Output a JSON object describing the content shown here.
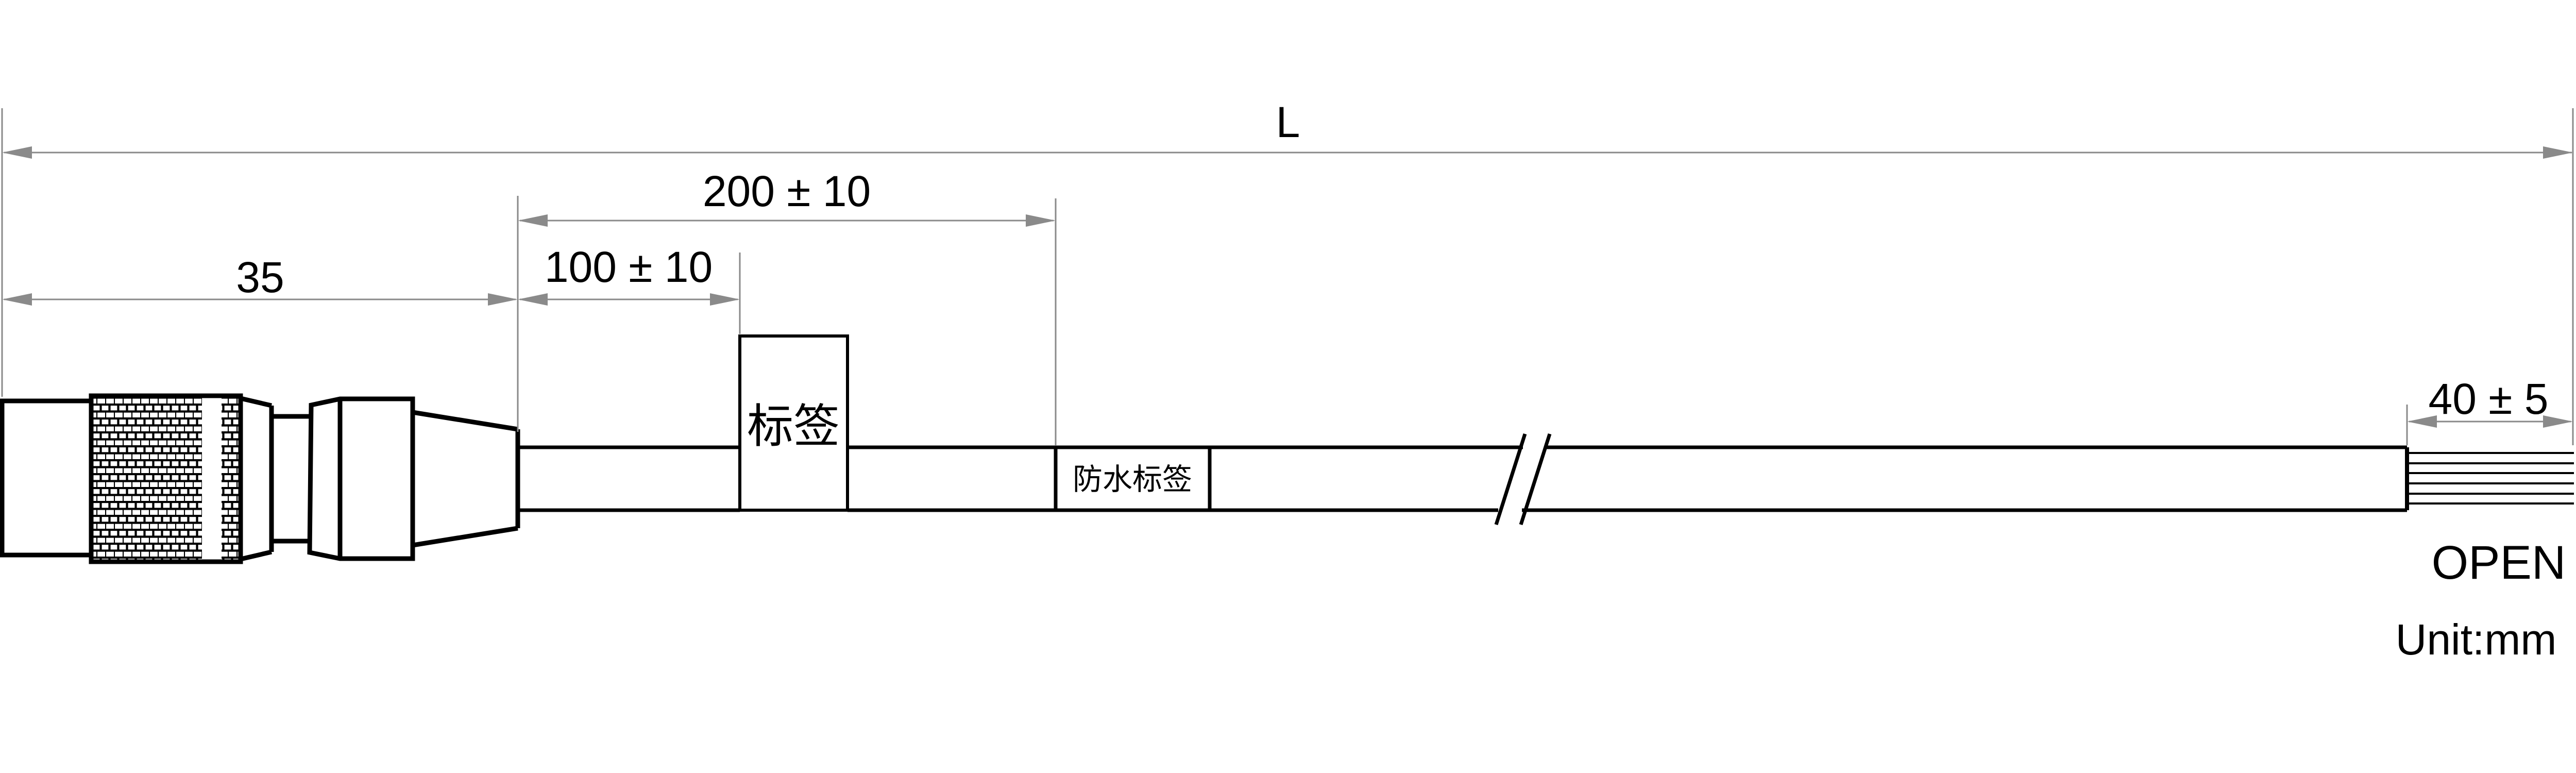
{
  "drawing": {
    "dimensions": {
      "overall_length": "L",
      "connector_length": "35",
      "first_label_offset": "100 ± 10",
      "waterproof_label_offset": "200 ± 10",
      "open_strip_length": "40 ± 5"
    },
    "labels": {
      "tag": "标签",
      "waterproof_tag": "防水标签",
      "cable_end": "OPEN",
      "unit_note": "Unit:mm"
    },
    "parts": {
      "connector": "circular-connector-with-knurled-ring",
      "cable": "cable-jacket",
      "wires": "open-wire-strands",
      "wire_count": 6
    },
    "colors": {
      "outline": "#000000",
      "dimension_gray": "#8a8a8a",
      "text": "#000000",
      "background": "#ffffff"
    }
  }
}
